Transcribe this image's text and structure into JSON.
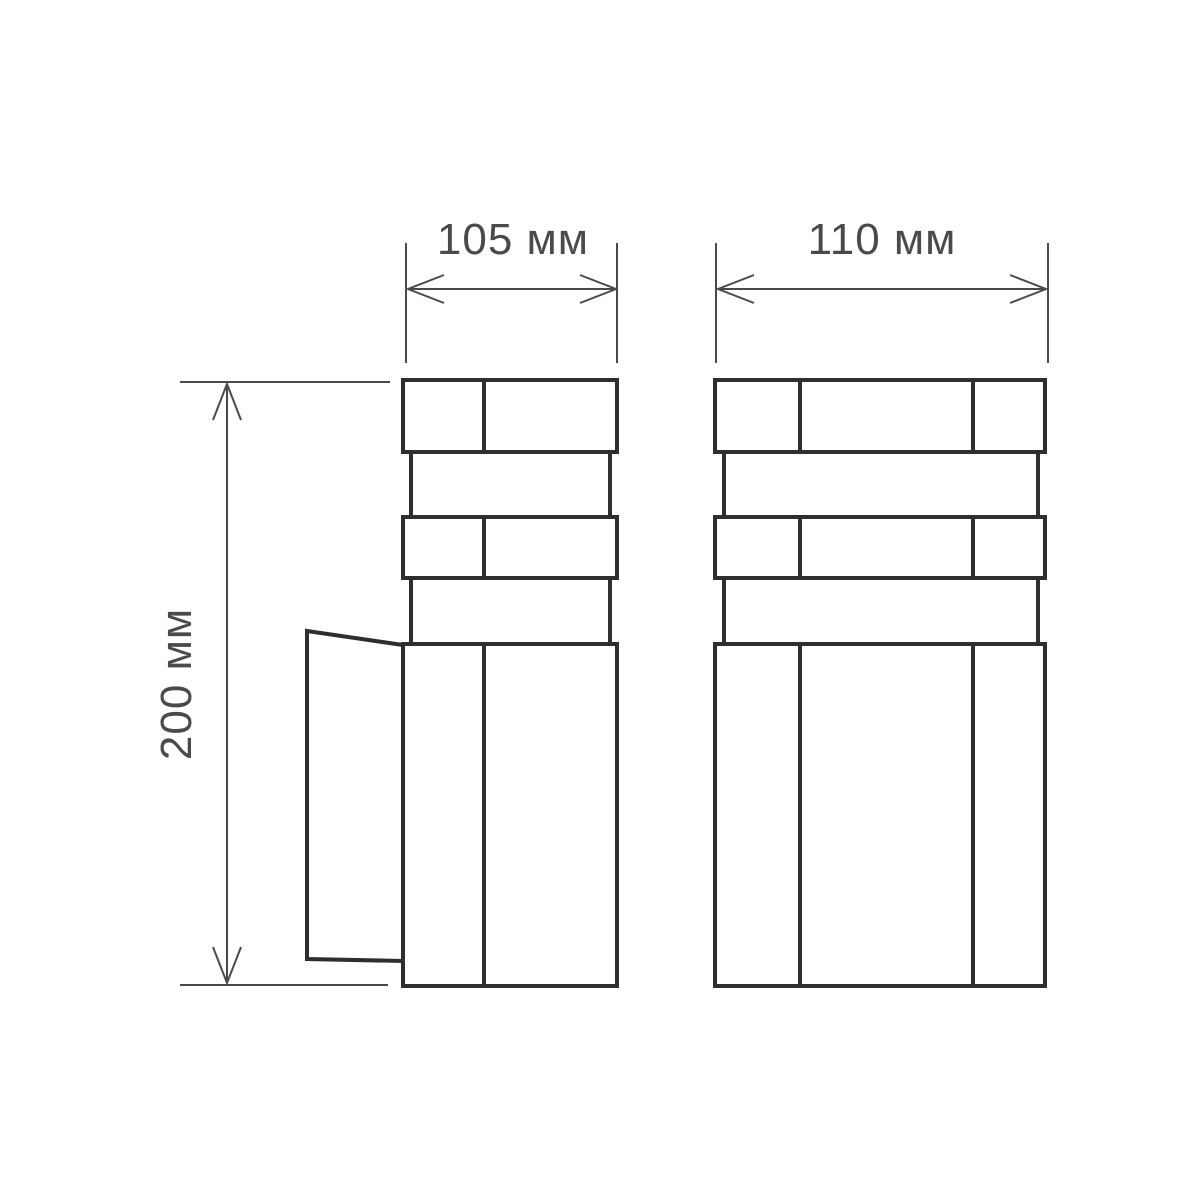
{
  "dimensions": {
    "side_width": {
      "label": "105 мм"
    },
    "front_width": {
      "label": "110 мм"
    },
    "height": {
      "label": "200 мм"
    }
  },
  "colors": {
    "outline": "#2e2e2e",
    "dimension": "#4a4a4a",
    "text": "#4a4a4a",
    "background": "#ffffff"
  }
}
